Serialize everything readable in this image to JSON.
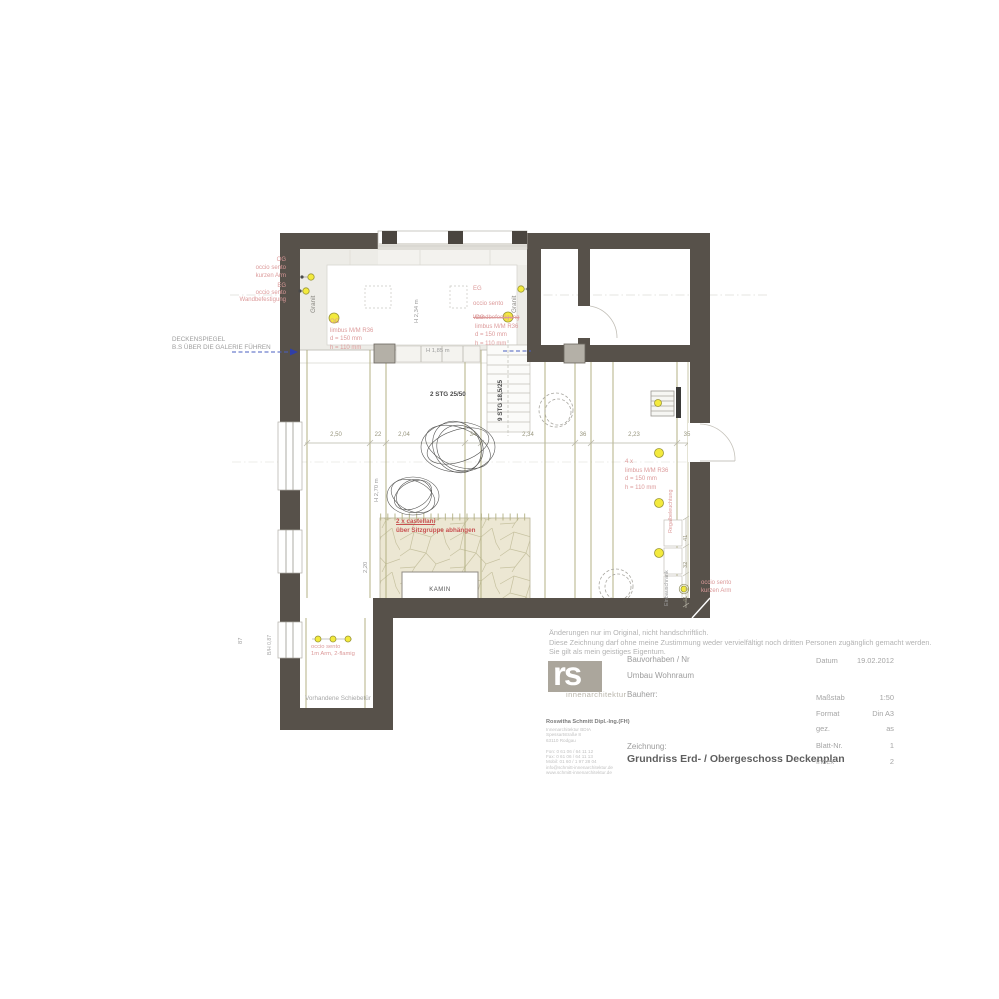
{
  "colors": {
    "wall": "#57514a",
    "annotation_red": "#dc9a9a",
    "strong_red": "#c85252",
    "light_yellow": "#f3ea3d",
    "beam_olive": "#b3b184",
    "dim_blue": "#4a5fc0",
    "stone_beige": "#ece7d3"
  },
  "plan": {
    "annotations": {
      "deckenspiegel": "DECKENSPIEGEL\nB.S ÜBER DIE GALERIE FÜHREN",
      "og_sento": "OG\noccio sento\nkurzen Arm",
      "eg_sento": "EG\noccio sento\nWandbefestigung",
      "eg_mid_1": "EG",
      "eg_mid_2": "occio sento",
      "eg_mid_3": "Wandbefestigung",
      "og_limbus": "OG\nlimbus M/M R36\nd = 150 mm\nh = 110 mm",
      "limbus_4x": "4 x\nlimbus M/M R36\nd = 150 mm\nh = 110 mm",
      "castellani_1": "2 x castellani",
      "castellani_2": "über Sitzgruppe abhängen",
      "sento_kurz": "occio sento\nkurzen Arm",
      "sento_2fl": "occio sento\n1m Arm, 2-flamig",
      "regal": "Regalbeleuchtung",
      "einbauschrank": "Einbauschrank",
      "vorhandene": "Vorhandene Schiebetür",
      "kamin": "KAMIN",
      "granit": "Granit",
      "stg2": "2 STG 25/50",
      "stg9": "9 STG 18,5/25",
      "h234": "H 2,34 m",
      "h185": "H 1,85 m",
      "h270": "H 2,70 m",
      "d220": "2,20",
      "d87": "87",
      "bh087": "B/H 0,87"
    },
    "dims_row": [
      "2,50",
      "22",
      "2,04",
      "34",
      "2,34",
      "36",
      "2,23",
      "35"
    ],
    "dims_right": [
      "41",
      "32",
      "41"
    ]
  },
  "titleblock": {
    "disclaimer": "Änderungen nur im Original, nicht handschriftlich.\nDiese Zeichnung darf ohne meine Zustimmung weder vervielfältigt noch dritten Personen zugänglich gemacht werden.\nSie gilt als mein geistiges Eigentum.",
    "logo_text": "rs",
    "logo_sub": "innenarchitektur",
    "firm_name": "Roswitha Schmitt Dipl.-Ing.(FH)",
    "firm_lines": "Innenarchitektur BDIA\nSpessartstraße 8\n63110 Rodgau\n\nFon:  0 61 06 / 64 11 12\nFax:  0 61 06 / 64 11 13\nMobil: 01 60 / 1 97 28 04\ninfo@schmitt-innenarchitektur.de\nwww.schmitt-innenarchitektur.de",
    "bauvorhaben_label": "Bauvorhaben / Nr",
    "bauvorhaben_value": "Umbau Wohnraum",
    "bauherr_label": "Bauherr:",
    "zeichnung_label": "Zeichnung:",
    "zeichnung_value": "Grundriss Erd- / Obergeschoss Deckenplan",
    "meta": [
      {
        "label": "Datum",
        "value": "19.02.2012"
      },
      {
        "label": "Maßstab",
        "value": "1:50"
      },
      {
        "label": "Format",
        "value": "Din A3"
      },
      {
        "label": "gez.",
        "value": "as"
      },
      {
        "label": "Blatt-Nr.",
        "value": "1"
      },
      {
        "label": "Index",
        "value": "2"
      }
    ]
  }
}
